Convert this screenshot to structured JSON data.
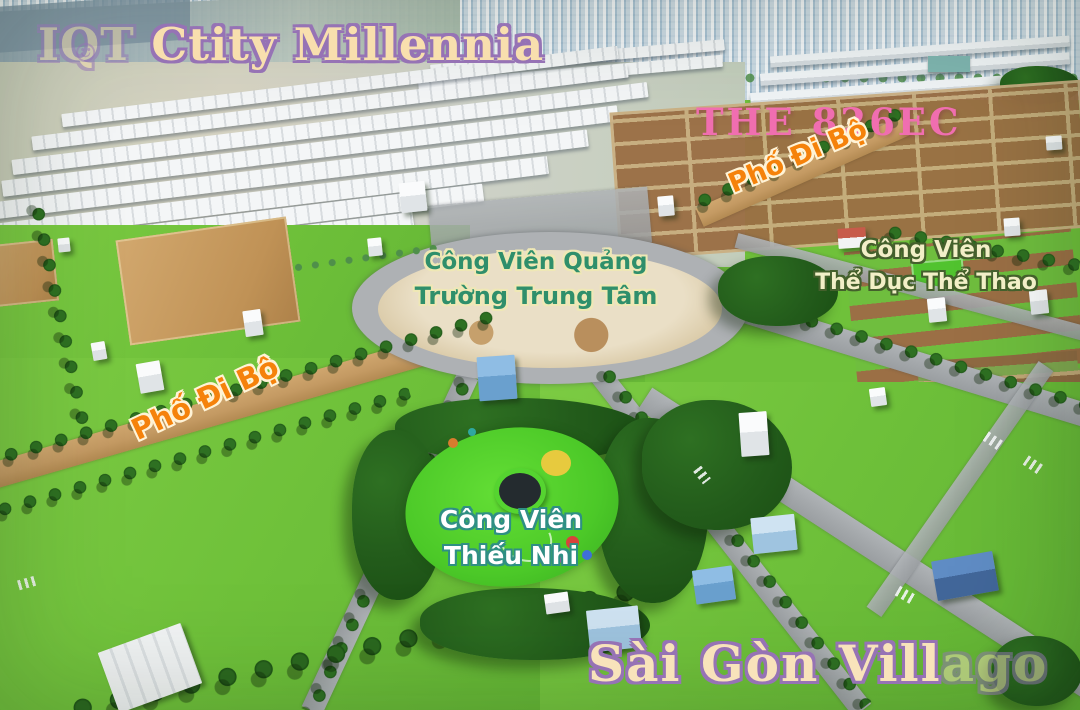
{
  "scene": {
    "type": "aerial-drone-photo",
    "subject": "real-estate land plots and parks",
    "colors": {
      "grass": "#6FC13A",
      "trees": "#1E5516",
      "dirt_road": "#C49A63",
      "asphalt_road": "#A4A8AB",
      "plaza_sand": "#E2D6BC",
      "marsh_water": "#93A7B2",
      "distant_city": "#D7E3EA"
    }
  },
  "overlays": {
    "project_title": {
      "prefix": "IQT",
      "logo_glyph": "☺",
      "text": "Ctity Millennia",
      "fill": "#F8DFAE",
      "outline": "#9673B5"
    },
    "the_826ec": {
      "text": "THE 826EC",
      "fill": "#F06EB0"
    },
    "pho_di_bo_right": {
      "text": "Phố Đi Bộ",
      "fill": "#F5820B",
      "outline": "#FFF3D6"
    },
    "pho_di_bo_left": {
      "text": "Phố Đi Bộ",
      "fill": "#F5820B",
      "outline": "#FFF3D6"
    },
    "quang_truong": {
      "line1": "Công Viên Quảng",
      "line2": "Trường Trung Tâm",
      "fill": "#2F8F6B",
      "outline": "#EFE8B5"
    },
    "the_duc_the_thao": {
      "line1": "Công Viên",
      "line2": "Thể Dục Thể Thao",
      "fill": "#F2EFC7",
      "outline": "#44602C"
    },
    "thieu_nhi": {
      "line1": "Công Viên",
      "line2": "Thiếu Nhi",
      "fill": "#FFFFFF",
      "outline": "#2F8F84"
    },
    "sai_gon_villago": {
      "text": "Sài Gòn Vill",
      "faded_suffix": "ago",
      "fill": "#F8E3BB",
      "outline": "#9B7FC2"
    }
  }
}
